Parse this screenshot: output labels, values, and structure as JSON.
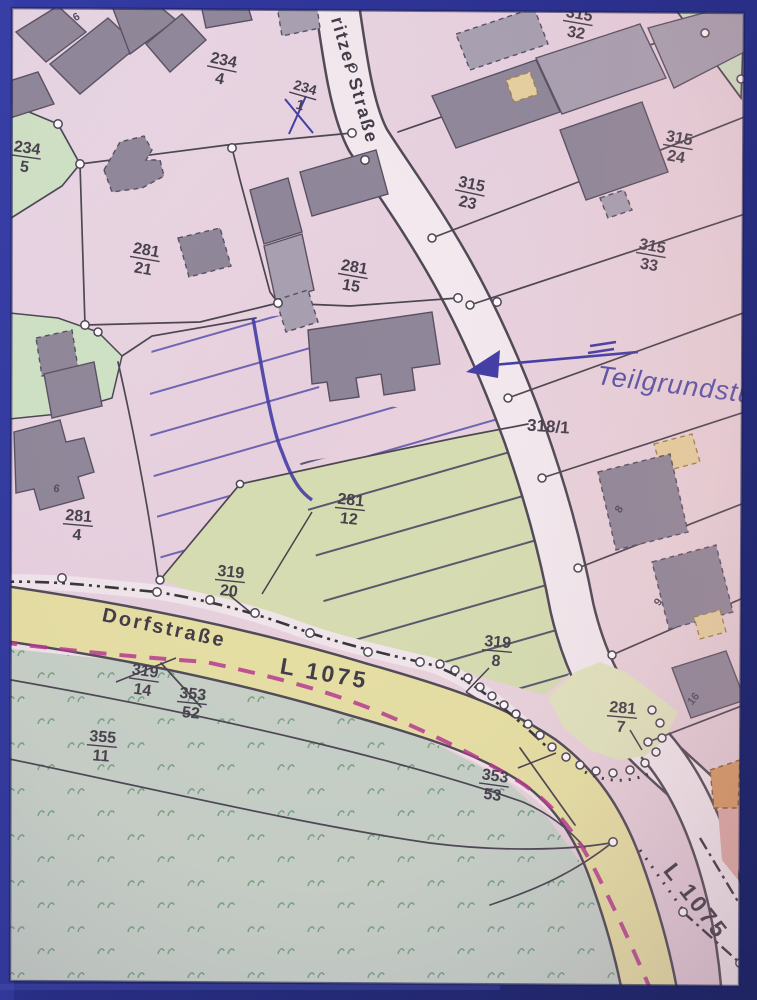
{
  "map": {
    "type": "cadastral-parcel-map-photo",
    "street_names": {
      "top_street": "ritzer Straße",
      "dorfstrasse": "Dorfstraße",
      "l1075_main": "L 1075",
      "l1075_corner": "L 1075"
    },
    "road_parcel_label": "318/1",
    "handwriting_note": "Teilgrundstück",
    "parcels": [
      {
        "num": "234",
        "den": "4"
      },
      {
        "num": "234",
        "den": "1"
      },
      {
        "num": "315",
        "den": "32"
      },
      {
        "num": "234",
        "den": "5"
      },
      {
        "num": "315",
        "den": "23"
      },
      {
        "num": "315",
        "den": "24"
      },
      {
        "num": "281",
        "den": "21"
      },
      {
        "num": "281",
        "den": "15"
      },
      {
        "num": "315",
        "den": "33"
      },
      {
        "num": "281",
        "den": "12"
      },
      {
        "num": "281",
        "den": "4"
      },
      {
        "num": "319",
        "den": "20"
      },
      {
        "num": "319",
        "den": "14"
      },
      {
        "num": "353",
        "den": "52"
      },
      {
        "num": "319",
        "den": "8"
      },
      {
        "num": "355",
        "den": "11"
      },
      {
        "num": "353",
        "den": "53"
      },
      {
        "num": "281",
        "den": "7"
      }
    ],
    "building_labels": {
      "tl": "6",
      "b281_4": "6",
      "b8": "8",
      "b9": "9",
      "b16": "16"
    },
    "colors": {
      "mat_blue": "#2b3192",
      "paper_pink": "#e7d1df",
      "road_white": "#f2e8ed",
      "road_yellow": "#e6dfa2",
      "parcel_green": "#cfe2c4",
      "area_green_olive": "#d6dcb0",
      "meadow_green": "#c6d0c6",
      "building_gray": "#8e8698",
      "ink_blue": "#423ba4",
      "boundary_magenta": "#b5368f"
    }
  }
}
